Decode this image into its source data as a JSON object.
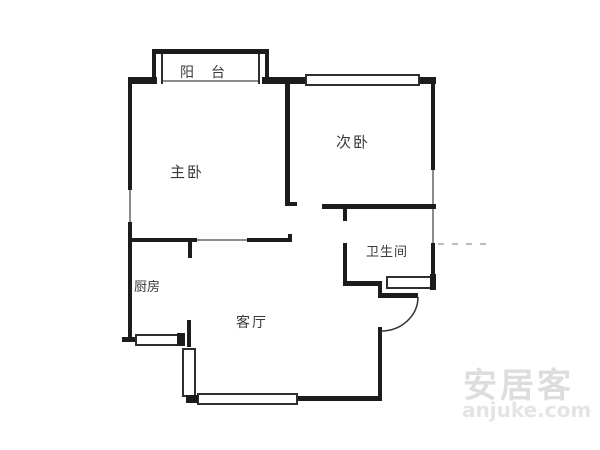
{
  "floorplan": {
    "rooms": {
      "balcony": {
        "label": "阳台"
      },
      "master_bedroom": {
        "label": "主卧"
      },
      "second_bedroom": {
        "label": "次卧"
      },
      "bathroom": {
        "label": "卫生间"
      },
      "kitchen": {
        "label": "厨房"
      },
      "living_room": {
        "label": "客厅"
      }
    },
    "colors": {
      "wall": "#1c1c1c",
      "thin_line": "#8c8c8c",
      "dashed_line": "#bbbbbb",
      "background": "#ffffff",
      "label_text": "#3a3a3a",
      "watermark": "#e0dddd"
    }
  },
  "watermark": {
    "brand": "安居客",
    "site": "anjuke.com"
  }
}
